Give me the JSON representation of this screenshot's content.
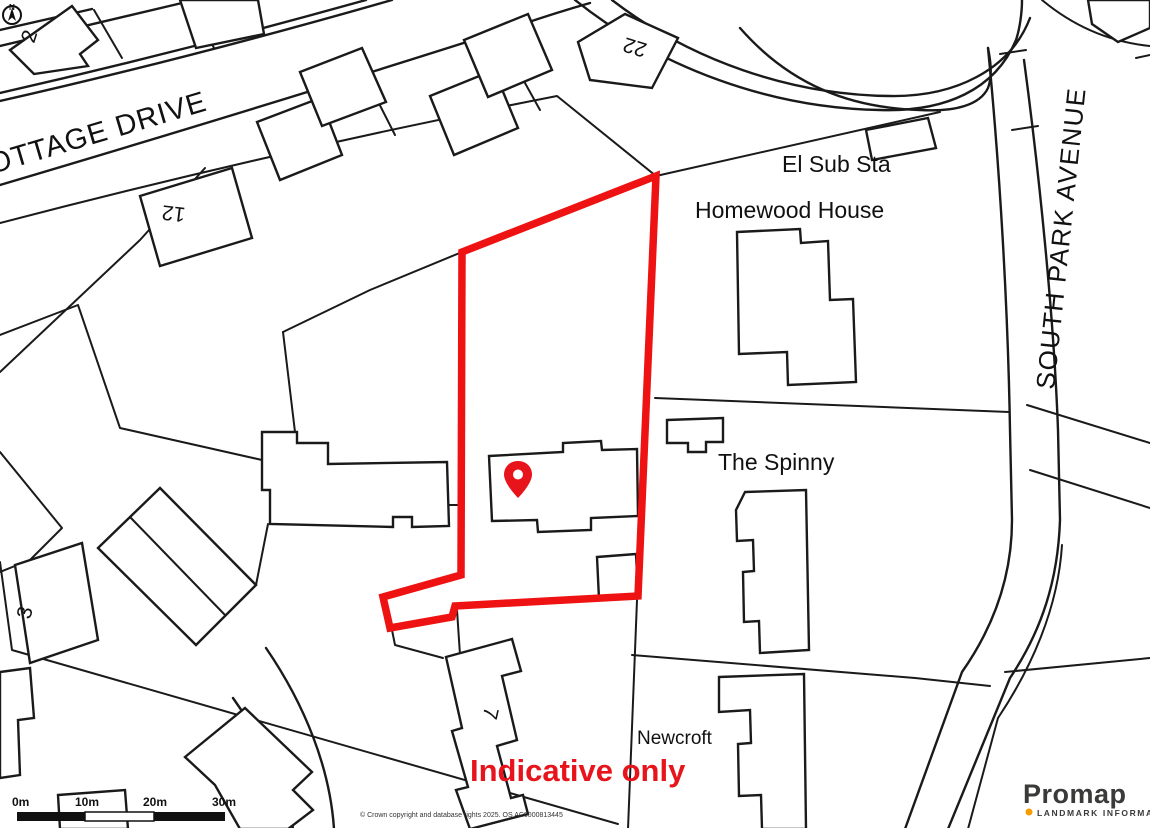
{
  "map": {
    "street_labels": {
      "cottage_drive": "OTTAGE DRIVE",
      "south_park_avenue": "SOUTH PARK AVENUE"
    },
    "place_labels": {
      "el_sub_sta": "El Sub Sta",
      "homewood_house": "Homewood House",
      "the_spinny": "The Spinny",
      "newcroft": "Newcroft"
    },
    "house_numbers": {
      "n2": "2",
      "n22": "22",
      "n12": "12",
      "n3": "3",
      "n7": "7"
    },
    "annotation": {
      "indicative_only": "Indicative only"
    },
    "colors": {
      "boundary_red": "#ee1212",
      "indicative_red": "#e8141c",
      "pin_red": "#e8141c",
      "line_black": "#1a1a1a",
      "promap_orange": "#f59e00",
      "promap_dark": "#3a3a39"
    }
  },
  "compass": {
    "label": "N"
  },
  "scale_bar": {
    "labels": [
      "0m",
      "10m",
      "20m",
      "30m"
    ]
  },
  "footer": {
    "copyright": "© Crown copyright and database rights 2025. OS AC0000813445"
  },
  "branding": {
    "name": "Promap",
    "tagline": "LANDMARK INFORMATION"
  }
}
